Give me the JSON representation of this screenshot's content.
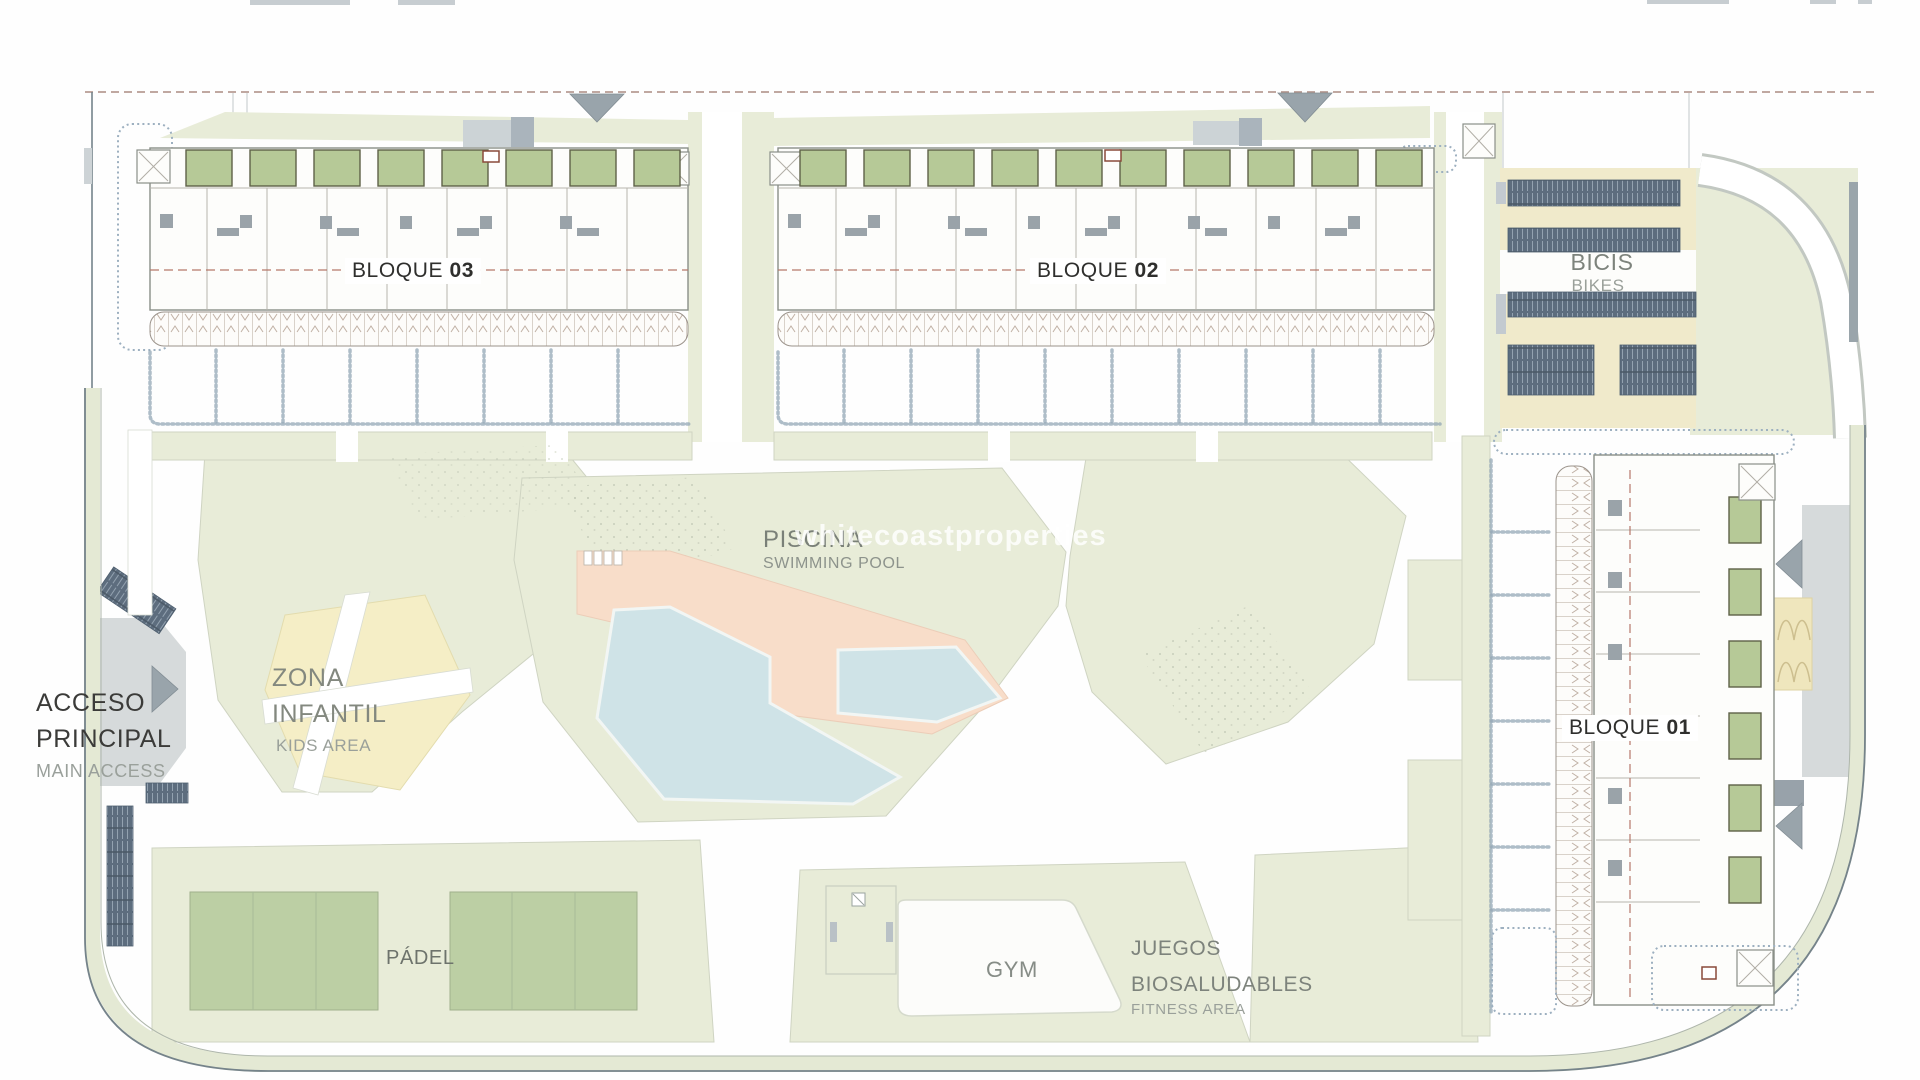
{
  "page": {
    "background": "#ffffff",
    "type": "residential development site plan"
  },
  "colors": {
    "landscape": "#e8ecd8",
    "patio_green": "#b6c997",
    "court_green": "#bccfa4",
    "pool_blue": "#cfe3e7",
    "deck_salmon": "#f8ddc9",
    "kids_yellow": "#f5eec6",
    "cream": "#f0eacb",
    "bike_dark": "#5d6d7e",
    "road_gray": "#d6dadb",
    "arrow_gray": "#99a4ab",
    "boundary_dash": "#ab8b82",
    "label_dash": "#b5786a",
    "text_dark": "#3b3b39",
    "text_gray": "#7d837c",
    "text_light": "#9aa09a"
  },
  "labels": {
    "bloque03": {
      "word": "BLOQUE ",
      "number": "03"
    },
    "bloque02": {
      "word": "BLOQUE ",
      "number": "02"
    },
    "bloque01": {
      "word": "BLOQUE ",
      "number": "01"
    },
    "bikes": {
      "primary": "BICIS",
      "secondary": "BIKES"
    },
    "pool": {
      "primary": "PISCINA",
      "secondary": "SWIMMING POOL"
    },
    "kids": {
      "line1": "ZONA",
      "line2": "INFANTIL",
      "secondary": "KIDS AREA"
    },
    "access": {
      "line1": "ACCESO",
      "line2": "PRINCIPAL",
      "secondary": "MAIN ACCESS"
    },
    "padel": {
      "primary": "PÁDEL"
    },
    "gym": {
      "primary": "GYM"
    },
    "fitness": {
      "line1": "JUEGOS",
      "line2": "BIOSALUDABLES",
      "secondary": "FITNESS AREA"
    },
    "watermark": "whitecoastproperties"
  }
}
